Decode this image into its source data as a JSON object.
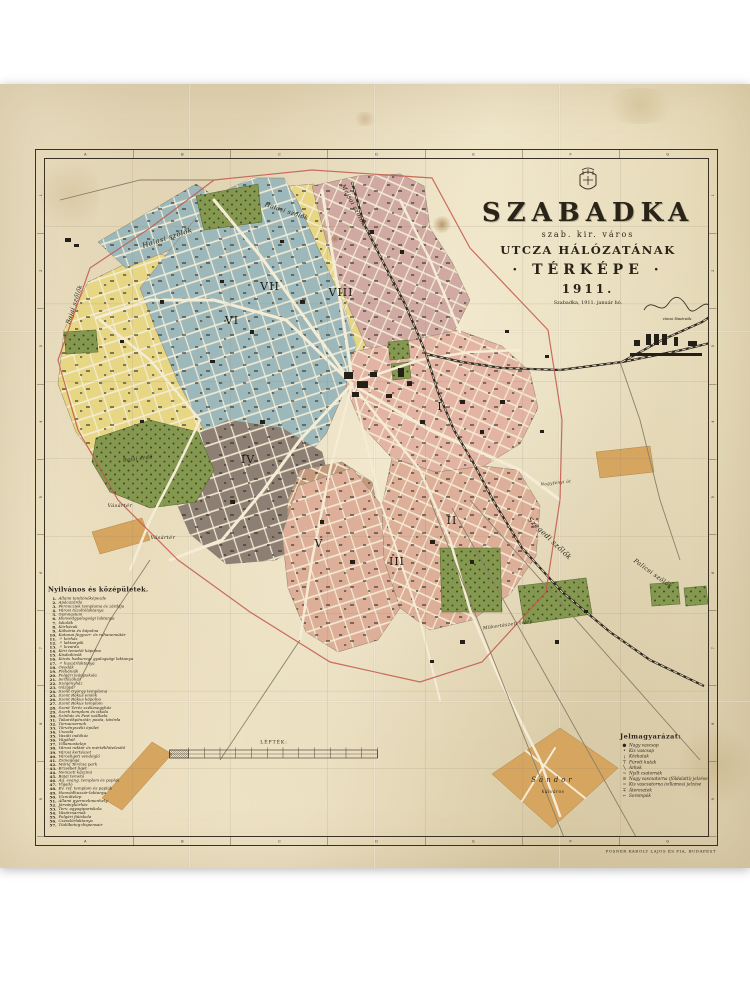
{
  "title_block": {
    "city": "SZABADKA",
    "subtitle1": "szab. kir. város",
    "subtitle2": "UTCZA HÁLÓZATÁNAK",
    "subtitle3": "· TÉRKÉPE ·",
    "year": "1911.",
    "dateline": "Szabadka, 1911. január hó.",
    "signature_caption": "városi főmérnök"
  },
  "frame": {
    "cols": [
      "A",
      "B",
      "C",
      "D",
      "E",
      "F",
      "G"
    ],
    "rows": [
      "1",
      "2",
      "3",
      "4",
      "5",
      "6",
      "7",
      "8",
      "9"
    ]
  },
  "legend_left": {
    "title": "Nyilvános és középületek.",
    "items": [
      "Állami tanítónőképezde",
      "Apácazárda",
      "Ferencziek temploma és zárdája",
      "Városi tűzoltólaktanya",
      "Gymnasium",
      "Honvédgyalogsági laktanya",
      "Iskolák",
      "Kórházak",
      "Kálvária és kápolna",
      "Katonai fegyver- és ruhanemütár",
      "〃  kórház",
      "〃  laktanyák",
      "〃  lovarda",
      "Kéri temetői kápolna",
      "Kisdedóvók",
      "Közös hadseregi gyalogsági laktanya",
      "〃  huszárlaktanya",
      "Óvodák",
      "Plébániák",
      "Polgári leányiskola",
      "Serfőzőház",
      "Szegényház",
      "Gázgyár",
      "Szent György temploma",
      "Szent Rókus emlék",
      "Szent Rókus kápolna",
      "Szent Rókus templom",
      "Szent Teréz székesegyház",
      "Szerb templom és iskola",
      "Színház és Pest szálloda",
      "Takarékpénztár, posta, távírda",
      "Tornacsarnok",
      "Törvényszéki épület",
      "Uszoda",
      "Vasúti indóház",
      "Vágóhíd",
      "Villamostelep",
      "Városi raktár és mértékhitelesítő",
      "Városi kertészet",
      "Városligeti vendéglő",
      "Zsinagóga",
      "Mária Terézia park",
      "Erzsébet liget",
      "Nemzeti kaszinó",
      "Bajai temető",
      "Ág. evang. templom és paplak",
      "Vigadó",
      "Ev. ref. templom és paplak",
      "Honvédhuszár-laktanya",
      "Vízműtelep",
      "Állami gyermekmenhely",
      "Járványkórház",
      "Terv. agyagipariskola",
      "Vásárcsarnok",
      "Polgári fiúiskola",
      "Csendőrlaktanya",
      "Tüdőbeteg-dispensair"
    ]
  },
  "legend_right": {
    "title": "Jelmagyarázat:",
    "items": [
      {
        "sym": "●",
        "label": "Nagy vascsap"
      },
      {
        "sym": "•",
        "label": "Kis vascsap"
      },
      {
        "sym": "¡",
        "label": "Közkutak"
      },
      {
        "sym": "⊤",
        "label": "Fúrott kutak"
      },
      {
        "sym": "╲",
        "label": "Árkok"
      },
      {
        "sym": "~",
        "label": "Nyílt csatornák"
      },
      {
        "sym": "≡",
        "label": "Nagy vascsatorna (földalatti) jelzése"
      },
      {
        "sym": "=",
        "label": "Kis vascsatorna (villamos) jelzése"
      },
      {
        "sym": "∓",
        "label": "Áteresztek"
      },
      {
        "sym": "⌐",
        "label": "Sorompók"
      }
    ]
  },
  "scalebar": {
    "title": "LÉPTÉK:"
  },
  "imprint": "POSNER KÁROLY LAJOS ÉS FIA, BUDAPEST",
  "colors": {
    "paper": "#eadfc0",
    "yellow": "#e7d684",
    "blue": "#9db8ba",
    "rose": "#cfa9a2",
    "salmon": "#e0b39f",
    "dark": "#8d7f74",
    "tan_v": "#c49a7e",
    "tan": "#d6a55f",
    "green": "#85984f",
    "street": "#f4ecd4",
    "rail": "#2e281f",
    "boundary_red": "#c2574a",
    "frame": "#3a3126"
  },
  "map": {
    "districts": [
      {
        "name": "yellow-west",
        "numeral": "",
        "color": "#e7d684",
        "pattern": "streetsB",
        "points": "88,282 150,252 196,262 214,300 240,346 247,398 228,448 196,478 152,492 108,474 76,432 58,384 64,330"
      },
      {
        "name": "vii",
        "numeral": "VII",
        "nx": 270,
        "ny": 290,
        "color": "#e7d684",
        "pattern": "streetsA",
        "points": "214,212 266,188 314,184 328,232 350,298 366,344 348,382 322,398 298,360 274,300 244,248"
      },
      {
        "name": "viii",
        "numeral": "VIII",
        "nx": 341,
        "ny": 296,
        "color": "#cfa9a2",
        "pattern": "streetsA",
        "points": "312,186 358,176 400,174 424,186 430,228 452,262 470,300 454,332 426,350 396,356 366,346 344,296 326,240"
      },
      {
        "name": "vi-strip",
        "numeral": "",
        "color": "#9db8ba",
        "pattern": "streetsB",
        "points": "98,242 196,184 214,196 170,250 126,268"
      },
      {
        "name": "vi",
        "numeral": "VI",
        "nx": 232,
        "ny": 324,
        "color": "#9db8ba",
        "pattern": "streetsB",
        "points": "140,288 170,250 214,196 252,178 284,178 298,202 318,248 342,300 356,346 344,392 326,434 296,470 262,490 232,468 204,430 178,382 156,330"
      },
      {
        "name": "iv",
        "numeral": "IV",
        "nx": 248,
        "ny": 463,
        "color": "#8d7f74",
        "pattern": "streetsB",
        "points": "176,444 228,420 282,428 322,452 332,492 314,536 276,560 226,564 190,534 170,488"
      },
      {
        "name": "v",
        "numeral": "V",
        "nx": 319,
        "ny": 547,
        "color": "#c49a7e",
        "pattern": "streetsA",
        "points": "300,470 342,462 372,482 380,520 370,560 336,586 302,576 286,540 288,500"
      },
      {
        "name": "iii",
        "numeral": "III",
        "nx": 397,
        "ny": 565,
        "color": "#ddae98",
        "pattern": "streetsB",
        "points": "298,486 352,468 382,506 384,560 400,608 378,640 338,652 306,632 288,588 282,534"
      },
      {
        "name": "ii",
        "numeral": "II",
        "nx": 452,
        "ny": 524,
        "color": "#ddae98",
        "pattern": "streetsA",
        "points": "392,458 436,472 484,466 518,470 540,506 536,556 510,594 472,620 430,630 400,608 384,560 382,506"
      },
      {
        "name": "i",
        "numeral": "I",
        "nx": 440,
        "ny": 410,
        "color": "#e3b4a4",
        "pattern": "streetsA",
        "points": "352,352 404,342 458,330 502,346 530,372 538,408 520,444 484,466 436,472 392,458 362,426 346,388"
      }
    ],
    "greens": [
      {
        "name": "park-north",
        "points": "196,196 258,184 262,222 204,230"
      },
      {
        "name": "park-left",
        "points": "64,332 96,330 98,352 66,354"
      },
      {
        "name": "bajai-erdo",
        "points": "96,438 150,420 198,432 214,470 196,502 150,508 110,492 92,462"
      },
      {
        "name": "park-south",
        "points": "440,548 500,548 502,612 442,612"
      },
      {
        "name": "park-southeast",
        "points": "518,586 586,578 592,614 524,624"
      },
      {
        "name": "park-east-a",
        "points": "650,584 678,582 680,604 652,606"
      },
      {
        "name": "park-east-b",
        "points": "684,588 706,586 708,604 686,606"
      },
      {
        "name": "park-ne-a",
        "points": "388,342 408,340 410,358 390,360"
      },
      {
        "name": "park-ne-b",
        "points": "391,364 409,362 411,378 393,380"
      }
    ],
    "tans": [
      {
        "name": "sandor-block",
        "points": "492,774 560,728 618,768 552,828"
      },
      {
        "name": "strip-sw",
        "points": "92,532 142,518 150,540 100,554"
      },
      {
        "name": "strip-bottom-left",
        "points": "102,798 152,742 172,754 122,810"
      },
      {
        "name": "block-right",
        "points": "596,452 650,446 654,472 600,478"
      }
    ],
    "roads": [
      {
        "pts": "352,384 262,258 214,200",
        "w": 3
      },
      {
        "pts": "352,384 286,320 214,300 150,300 96,318",
        "w": 3
      },
      {
        "pts": "352,384 300,440 262,492 222,540 170,560",
        "w": 3
      },
      {
        "pts": "352,384 330,470 312,560 300,640",
        "w": 2.5
      },
      {
        "pts": "358,392 420,470 450,540 470,610 500,680 540,760 560,816",
        "w": 2.5
      },
      {
        "pts": "358,388 430,430 520,470 560,500",
        "w": 3
      },
      {
        "pts": "360,380 420,360 470,352 520,350",
        "w": 2.5
      },
      {
        "pts": "352,378 340,300 330,240 322,190",
        "w": 3
      },
      {
        "pts": "352,384 380,500 420,620 440,700",
        "w": 2
      },
      {
        "pts": "100,320 150,360 200,420 176,470 150,520 130,570",
        "w": 2.5
      },
      {
        "pts": "460,332 430,260 400,200",
        "w": 2.5
      },
      {
        "pts": "526,751 585,798",
        "w": 2
      },
      {
        "pts": "555,748 522,801",
        "w": 2
      }
    ],
    "paths": [
      "430,500 565,840",
      "452,508 640,844",
      "470,500 700,760",
      "300,640 260,700 220,760",
      "150,560 110,620 80,680",
      "60,200 140,180 214,180",
      "620,362 640,420 660,500 680,560"
    ],
    "railways": [
      {
        "name": "railway-main",
        "points": "352,182 364,224 384,264 404,302 418,334 426,354 438,392 454,430 474,464 494,502 522,548 562,592 610,632 650,660 704,686"
      },
      {
        "name": "railway-east",
        "points": "426,354 462,362 502,368 560,370 622,362 682,350 714,342"
      },
      {
        "name": "railway-ne-spur",
        "points": "622,362 662,340 702,322 714,314"
      }
    ],
    "boundary": "214,180 312,170 432,178 470,248 548,330 562,420 560,500 546,592 482,662 420,682 330,662 250,612 178,560 118,500 78,430 58,360 90,268 150,228",
    "buildings": [
      [
        344,
        372,
        9,
        7
      ],
      [
        357,
        381,
        11,
        7
      ],
      [
        370,
        372,
        7,
        5
      ],
      [
        352,
        392,
        7,
        5
      ],
      [
        398,
        368,
        6,
        9
      ],
      [
        407,
        381,
        5,
        5
      ],
      [
        386,
        394,
        6,
        4
      ],
      [
        646,
        334,
        5,
        11
      ],
      [
        654,
        334,
        5,
        11
      ],
      [
        662,
        334,
        5,
        11
      ],
      [
        674,
        337,
        4,
        9
      ],
      [
        634,
        340,
        6,
        6
      ],
      [
        688,
        341,
        9,
        5
      ],
      [
        630,
        353,
        72,
        3
      ],
      [
        300,
        300,
        5,
        4
      ],
      [
        250,
        330,
        4,
        4
      ],
      [
        210,
        360,
        5,
        3
      ],
      [
        160,
        300,
        4,
        4
      ],
      [
        120,
        340,
        4,
        3
      ],
      [
        260,
        420,
        5,
        4
      ],
      [
        230,
        500,
        5,
        4
      ],
      [
        420,
        420,
        5,
        4
      ],
      [
        460,
        400,
        5,
        4
      ],
      [
        480,
        430,
        4,
        4
      ],
      [
        430,
        540,
        5,
        4
      ],
      [
        470,
        560,
        4,
        4
      ],
      [
        350,
        560,
        5,
        4
      ],
      [
        320,
        520,
        4,
        4
      ],
      [
        400,
        250,
        4,
        4
      ],
      [
        370,
        230,
        4,
        4
      ],
      [
        280,
        240,
        4,
        3
      ],
      [
        220,
        280,
        4,
        3
      ],
      [
        140,
        420,
        4,
        3
      ],
      [
        500,
        400,
        5,
        4
      ],
      [
        540,
        430,
        4,
        3
      ],
      [
        65,
        238,
        6,
        4
      ],
      [
        74,
        244,
        5,
        3
      ],
      [
        460,
        640,
        5,
        4
      ],
      [
        430,
        660,
        4,
        3
      ],
      [
        555,
        640,
        4,
        4
      ],
      [
        584,
        610,
        4,
        3
      ],
      [
        505,
        330,
        4,
        3
      ],
      [
        545,
        355,
        4,
        3
      ]
    ],
    "labels": [
      {
        "t": "Halasi szőlők",
        "x": 168,
        "y": 240,
        "r": -18,
        "s": 7
      },
      {
        "t": "Halasi szőlők",
        "x": 286,
        "y": 213,
        "r": 18,
        "s": 6
      },
      {
        "t": "Majsai szőlők",
        "x": 352,
        "y": 206,
        "r": 62,
        "s": 6
      },
      {
        "t": "Bajai szőlők",
        "x": 76,
        "y": 305,
        "r": -72,
        "s": 6
      },
      {
        "t": "Szegedi szőlők",
        "x": 548,
        "y": 540,
        "r": 44,
        "s": 7
      },
      {
        "t": "Palicsi szőlők",
        "x": 652,
        "y": 575,
        "r": 36,
        "s": 6
      },
      {
        "t": "Bajai erdő",
        "x": 138,
        "y": 460,
        "r": -6,
        "s": 5
      },
      {
        "t": "Vásártér",
        "x": 120,
        "y": 507,
        "r": 0,
        "s": 5
      },
      {
        "t": "Vásártér",
        "x": 163,
        "y": 539,
        "r": 0,
        "s": 5
      },
      {
        "t": "Mükertészeti telep",
        "x": 508,
        "y": 626,
        "r": -8,
        "s": 4.5
      },
      {
        "t": "Nagyfényi út",
        "x": 556,
        "y": 484,
        "r": -6,
        "s": 4
      },
      {
        "t": "Sándor",
        "x": 553,
        "y": 782,
        "r": 0,
        "s": 7,
        "ls": 3
      },
      {
        "t": "külváros",
        "x": 553,
        "y": 793,
        "r": 0,
        "s": 4.5
      }
    ]
  }
}
